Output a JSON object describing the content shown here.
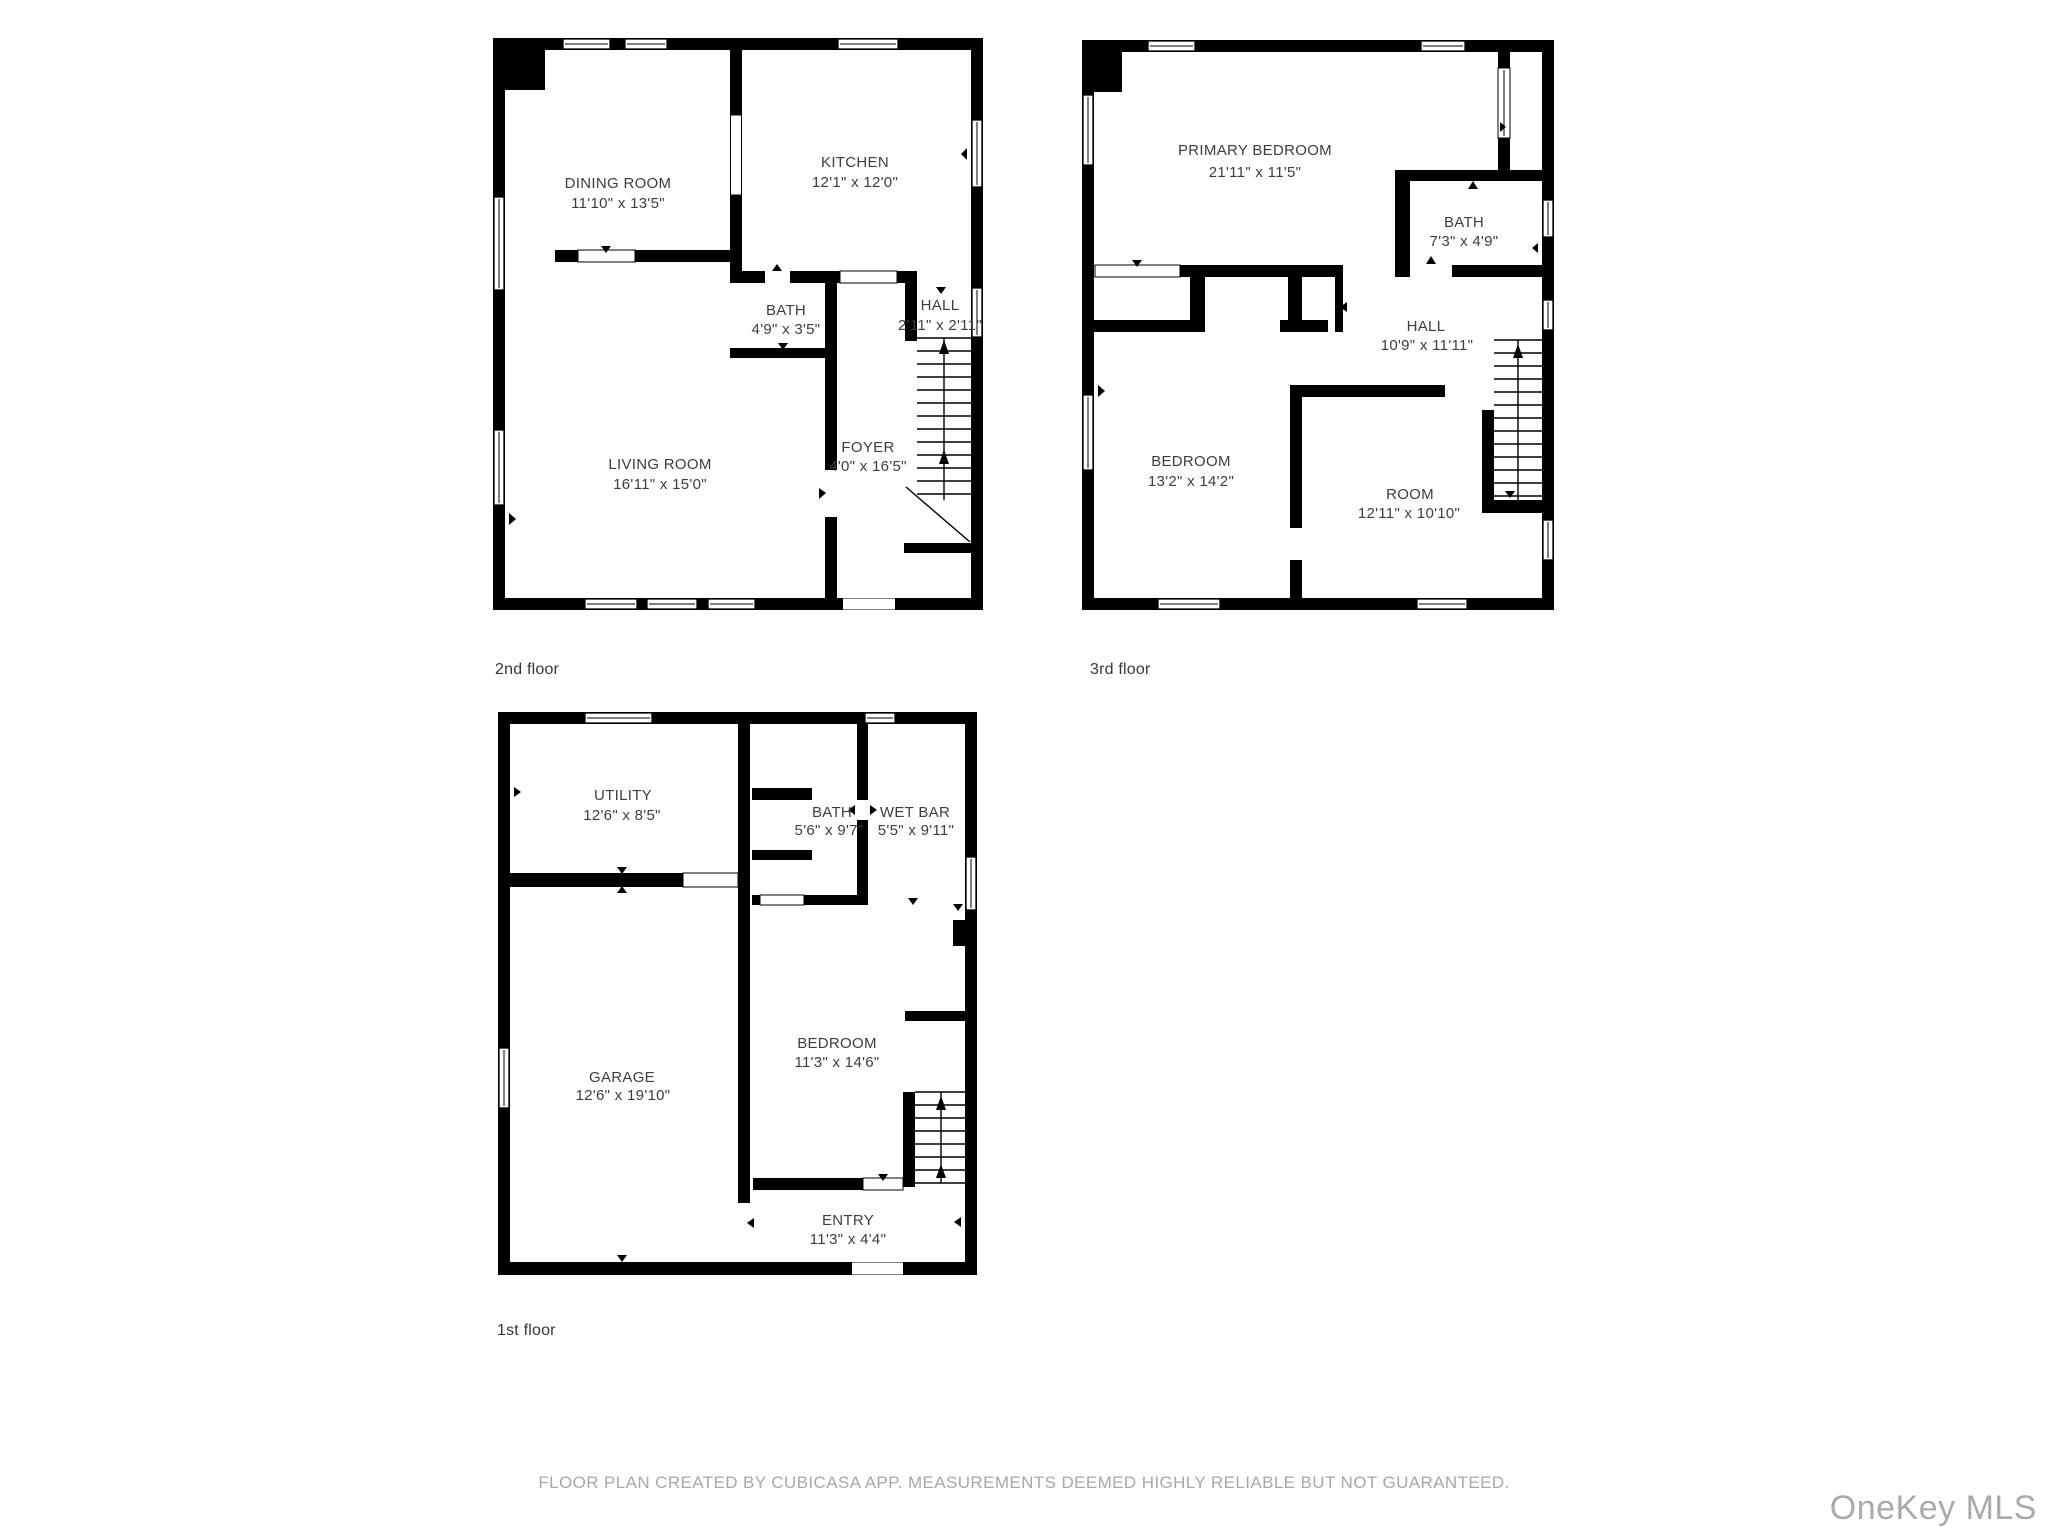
{
  "floors": {
    "second": {
      "label": "2nd floor",
      "rooms": {
        "dining": {
          "name": "DINING ROOM",
          "dims": "11'10\" x 13'5\""
        },
        "kitchen": {
          "name": "KITCHEN",
          "dims": "12'1\" x 12'0\""
        },
        "bath": {
          "name": "BATH",
          "dims": "4'9\" x 3'5\""
        },
        "hall": {
          "name": "HALL",
          "dims": "2'11\" x 2'11\""
        },
        "living": {
          "name": "LIVING ROOM",
          "dims": "16'11\" x 15'0\""
        },
        "foyer": {
          "name": "FOYER",
          "dims": "4'0\" x 16'5\""
        }
      }
    },
    "third": {
      "label": "3rd floor",
      "rooms": {
        "primary": {
          "name": "PRIMARY BEDROOM",
          "dims": "21'11\" x 11'5\""
        },
        "bath": {
          "name": "BATH",
          "dims": "7'3\" x 4'9\""
        },
        "hall": {
          "name": "HALL",
          "dims": "10'9\" x 11'11\""
        },
        "bedroom": {
          "name": "BEDROOM",
          "dims": "13'2\" x 14'2\""
        },
        "room": {
          "name": "ROOM",
          "dims": "12'11\" x 10'10\""
        }
      }
    },
    "first": {
      "label": "1st floor",
      "rooms": {
        "utility": {
          "name": "UTILITY",
          "dims": "12'6\" x 8'5\""
        },
        "bath": {
          "name": "BATH",
          "dims": "5'6\" x 9'7\""
        },
        "wetbar": {
          "name": "WET BAR",
          "dims": "5'5\" x 9'11\""
        },
        "garage": {
          "name": "GARAGE",
          "dims": "12'6\" x 19'10\""
        },
        "bedroom": {
          "name": "BEDROOM",
          "dims": "11'3\" x 14'6\""
        },
        "entry": {
          "name": "ENTRY",
          "dims": "11'3\" x 4'4\""
        }
      }
    }
  },
  "footer": {
    "text": "FLOOR PLAN CREATED BY CUBICASA APP. MEASUREMENTS DEEMED HIGHLY RELIABLE BUT NOT GUARANTEED."
  },
  "watermark": {
    "text": "OneKey MLS"
  },
  "colors": {
    "wall": "#000000",
    "room_text": "#3a3e44",
    "footer_text": "#a4a9af",
    "watermark_text": "#aaaaaa",
    "background": "#ffffff"
  }
}
